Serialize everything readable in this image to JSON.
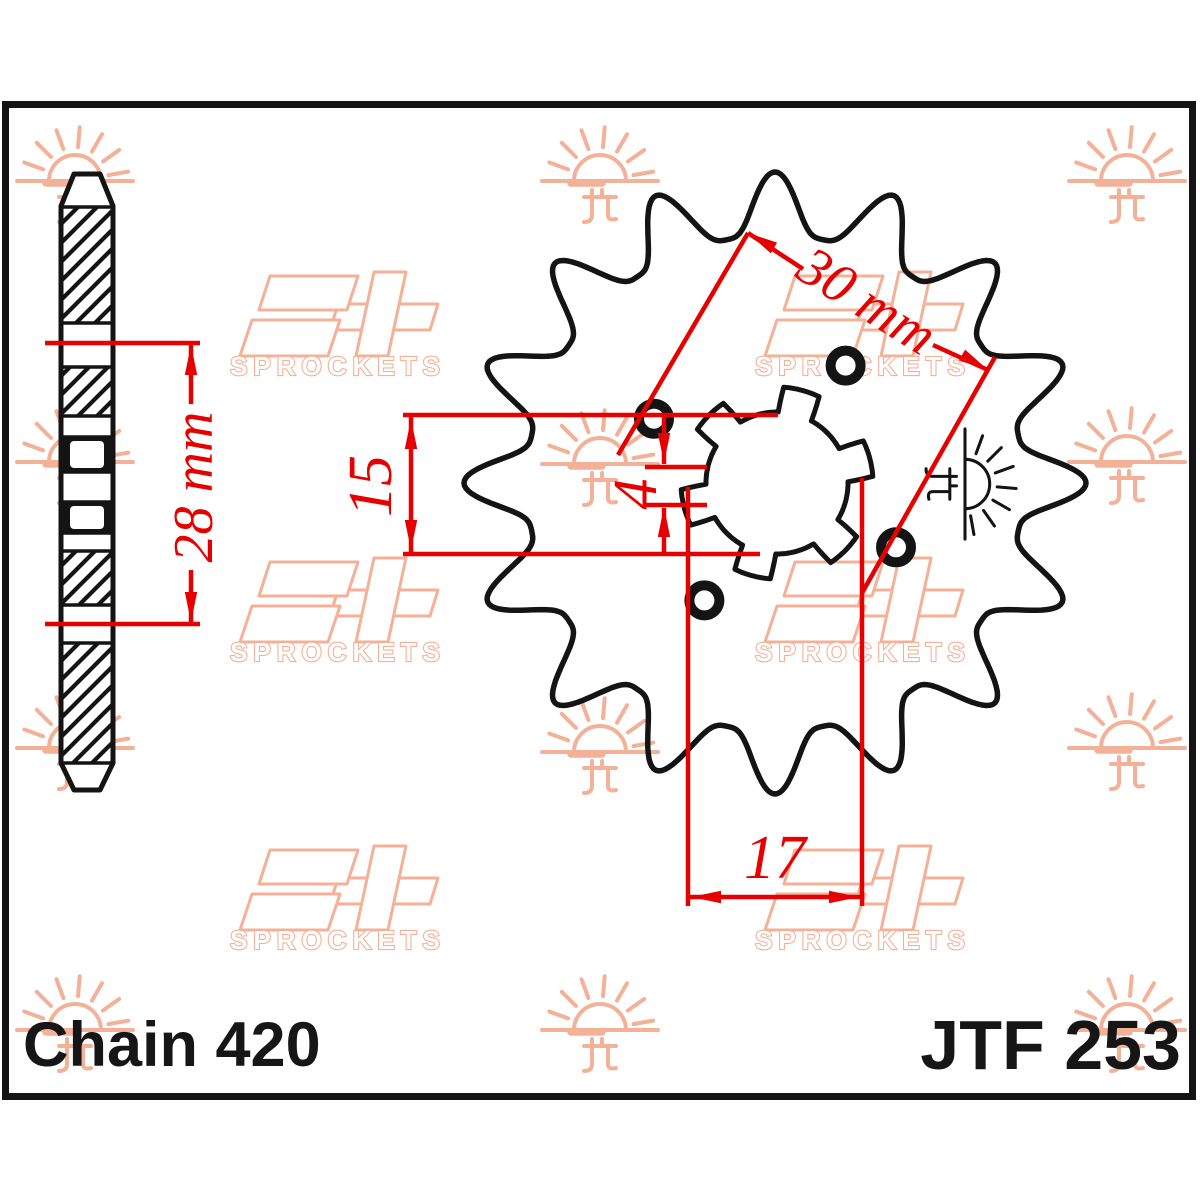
{
  "part": {
    "chain_label": "Chain 420",
    "part_number": "JTF 253"
  },
  "dimensions": {
    "side_width": "28 mm",
    "tooth_span": "15",
    "offset": "4",
    "bolt_circle": "30 mm",
    "bore": "17"
  },
  "watermark": {
    "sprockets_label": "SPROCKETS",
    "sun_icon": "sun-with-horizon-and-jt-mark",
    "logo_icon": "jt-logo"
  },
  "colors": {
    "dimension_red": "#e60000",
    "ink": "#141414",
    "watermark_peach": "#f3b197",
    "background": "#ffffff"
  },
  "drawing": {
    "front": {
      "cx": 775,
      "cy": 483,
      "teeth": 16,
      "tip_radius": 311,
      "root_radius": 248,
      "outline_stroke": 5.5,
      "bolt_circle_radius": 137,
      "bolt_hole_angles": [
        59,
        152,
        239,
        332
      ],
      "bolt_hole_ring_radius": 15,
      "bolt_hole_ring_stroke": 10,
      "spline": {
        "base_radius": 71,
        "tab_radius": 96,
        "tab_centers": [
          15,
          75,
          135,
          195,
          255,
          315
        ],
        "tab_half_width": 14,
        "tab_flat_half_width": 11
      },
      "stamp": {
        "x": 965,
        "y": 484,
        "rotate": 90,
        "scale": 0.95
      }
    },
    "side": {
      "x": 61,
      "w": 52,
      "outline": [
        [
          74,
          174
        ],
        [
          100,
          174
        ],
        [
          113,
          206
        ],
        [
          113,
          763
        ],
        [
          100,
          790
        ],
        [
          74,
          790
        ],
        [
          61,
          763
        ],
        [
          61,
          206
        ]
      ],
      "hatch_blocks": [
        [
          207,
          116
        ],
        [
          367,
          49
        ],
        [
          551,
          54
        ],
        [
          643,
          120
        ]
      ],
      "separators": [
        207,
        323,
        367,
        416,
        437,
        472,
        502,
        533,
        551,
        605,
        643,
        763
      ],
      "spline_blocks": [
        {
          "y": 437,
          "h": 35,
          "iy": 441,
          "ih": 27
        },
        {
          "y": 502,
          "h": 31,
          "iy": 506,
          "ih": 23
        }
      ],
      "inner_x": 70,
      "inner_w": 34
    },
    "suns": [
      [
        75,
        181
      ],
      [
        600,
        181
      ],
      [
        1127,
        181
      ],
      [
        75,
        462
      ],
      [
        600,
        464
      ],
      [
        1127,
        462
      ],
      [
        75,
        748
      ],
      [
        600,
        752
      ],
      [
        1127,
        748
      ],
      [
        75,
        1030
      ],
      [
        600,
        1030
      ],
      [
        1127,
        1030
      ]
    ],
    "logos": [
      [
        234,
        272
      ],
      [
        759,
        272
      ],
      [
        234,
        558
      ],
      [
        759,
        558
      ],
      [
        234,
        846
      ],
      [
        759,
        846
      ]
    ],
    "red_lines": [
      [
        45,
        343,
        200,
        343
      ],
      [
        45,
        624,
        200,
        624
      ],
      [
        191,
        343,
        191,
        404
      ],
      [
        191,
        570,
        191,
        624
      ],
      [
        403,
        415,
        778,
        415
      ],
      [
        403,
        554,
        760,
        554
      ],
      [
        411,
        417,
        411,
        552
      ],
      [
        645,
        467,
        707,
        467
      ],
      [
        645,
        505,
        707,
        505
      ],
      [
        664,
        416,
        664,
        464
      ],
      [
        664,
        508,
        664,
        553
      ],
      [
        688,
        487,
        688,
        906
      ],
      [
        862,
        478,
        862,
        906
      ],
      [
        689,
        897,
        861,
        897
      ],
      [
        748,
        233,
        618,
        455
      ],
      [
        995,
        357,
        862,
        593
      ],
      [
        748,
        233,
        803,
        269
      ],
      [
        933,
        345,
        988,
        370
      ]
    ],
    "arrows": [
      [
        191,
        345,
        -90
      ],
      [
        191,
        622,
        90
      ],
      [
        411,
        419,
        -90
      ],
      [
        411,
        550,
        90
      ],
      [
        664,
        463,
        90
      ],
      [
        664,
        507,
        -90
      ],
      [
        691,
        897,
        180
      ],
      [
        859,
        897,
        0
      ],
      [
        748,
        233,
        210
      ],
      [
        988,
        370,
        30
      ]
    ],
    "frame": {
      "x": 5.5,
      "y": 104.5,
      "w": 1187,
      "h": 992,
      "stroke": 7
    }
  }
}
